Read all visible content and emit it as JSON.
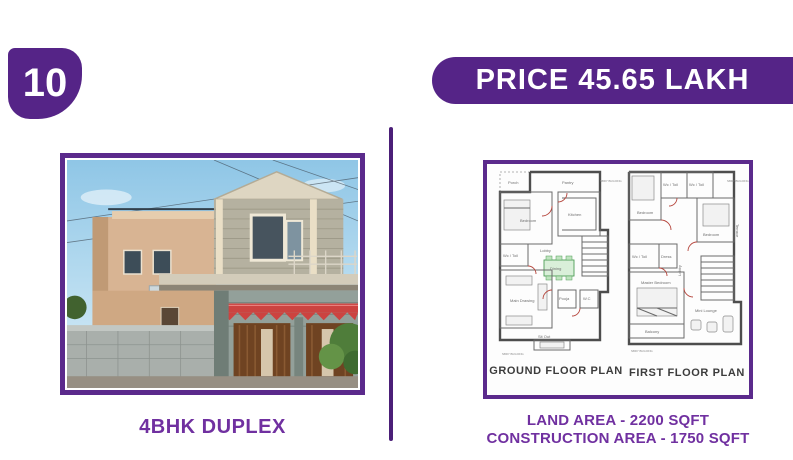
{
  "colors": {
    "brand": "#552487",
    "brand-dark": "#4b1f78",
    "accent-text": "#7030a0",
    "page-bg": "#ffffff"
  },
  "badge": {
    "number": "10"
  },
  "price_banner": {
    "label": "PRICE 45.65 LAKH"
  },
  "left_panel": {
    "caption": "4BHK DUPLEX"
  },
  "right_panel": {
    "ground_plan": {
      "title": "GROUND FLOOR PLAN",
      "rooms": [
        "Porch",
        "Pantry",
        "Bedroom",
        "Kitchen",
        "Lobby",
        "Wc / Toil",
        "Dining",
        "Main Drawing",
        "Pooja",
        "W.C",
        "Sit Out"
      ],
      "note": "NBRY BUILDING"
    },
    "first_plan": {
      "title": "FIRST FLOOR PLAN",
      "rooms": [
        "Wc / Toil",
        "Wc / Toil",
        "Bedroom",
        "Bedroom",
        "Wc / Toil",
        "Dress",
        "Lobby",
        "Master Bedroom",
        "Balcony",
        "Mini Lounge",
        "Terrace"
      ],
      "note": "NBRY BUILDING"
    },
    "land_area": "LAND AREA - 2200 SQFT",
    "construction_area": "CONSTRUCTION AREA - 1750 SQFT"
  }
}
